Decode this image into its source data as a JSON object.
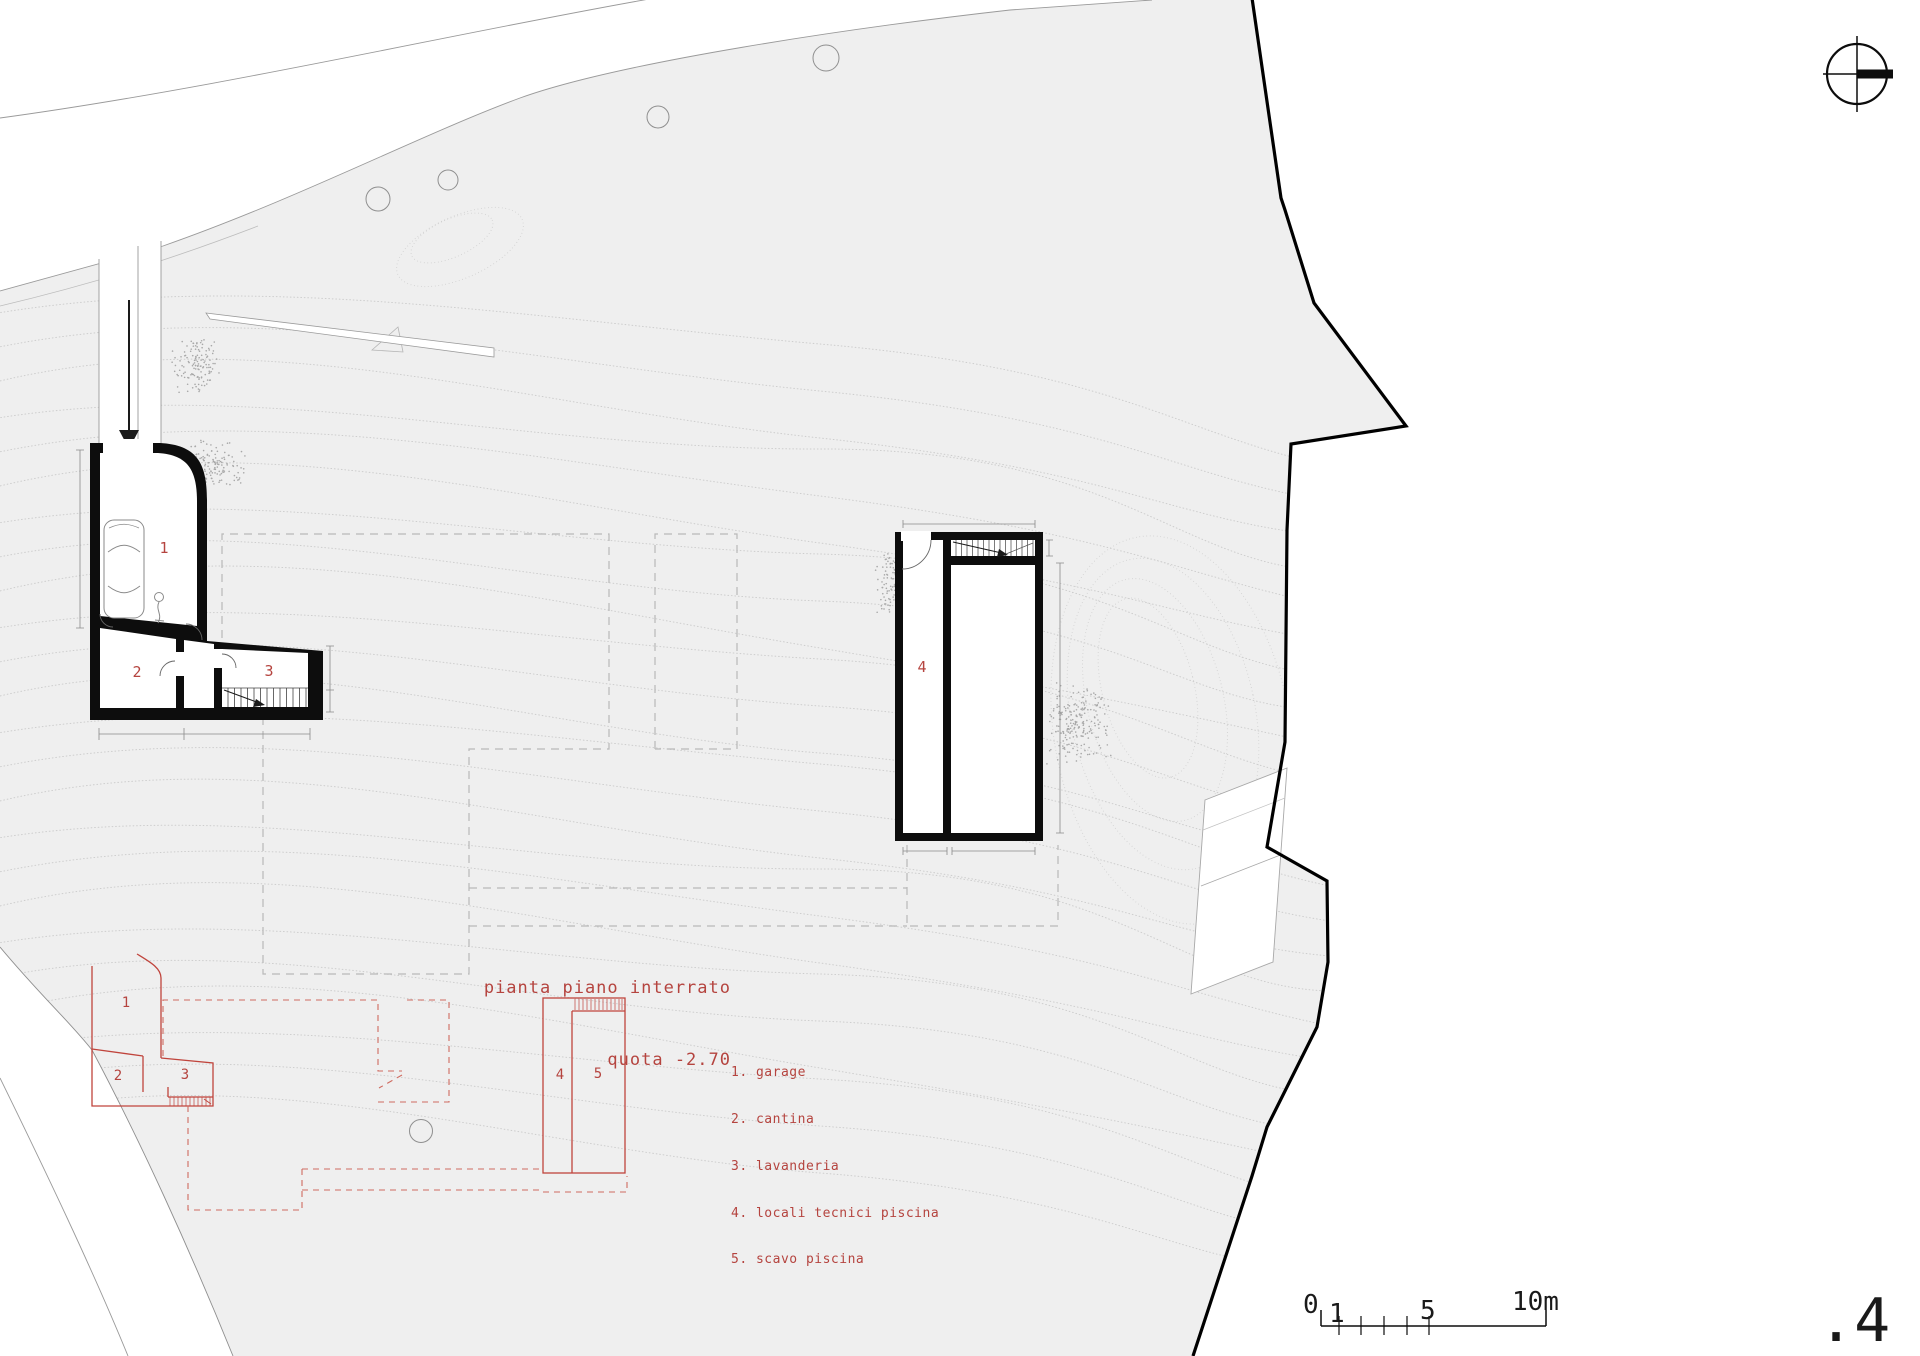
{
  "sheet": {
    "page_number": ".4"
  },
  "title": {
    "line1": "pianta piano interrato",
    "line2": "quota -2.70"
  },
  "legend": {
    "items": [
      "1. garage",
      "2. cantina",
      "3. lavanderia",
      "4. locali tecnici piscina",
      "5. scavo piscina"
    ]
  },
  "plan_labels": {
    "garage": "1",
    "cantina": "2",
    "lavanderia": "3",
    "locali_tecnici": "4"
  },
  "red_plan_labels": {
    "garage": "1",
    "cantina": "2",
    "lavanderia": "3",
    "locali_tecnici": "4",
    "scavo_piscina": "5"
  },
  "scale_bar": {
    "start": "0",
    "one": "1",
    "five": "5",
    "end": "10m"
  },
  "colors": {
    "site_fill": "#efefef",
    "contour_line": "#cdcdcd",
    "plan_red": "#c0443c",
    "dashed_red": "#cf6b60",
    "text_red": "#b5443f",
    "dashed_gray": "#b9b9b9",
    "boundary_black": "#000000"
  }
}
